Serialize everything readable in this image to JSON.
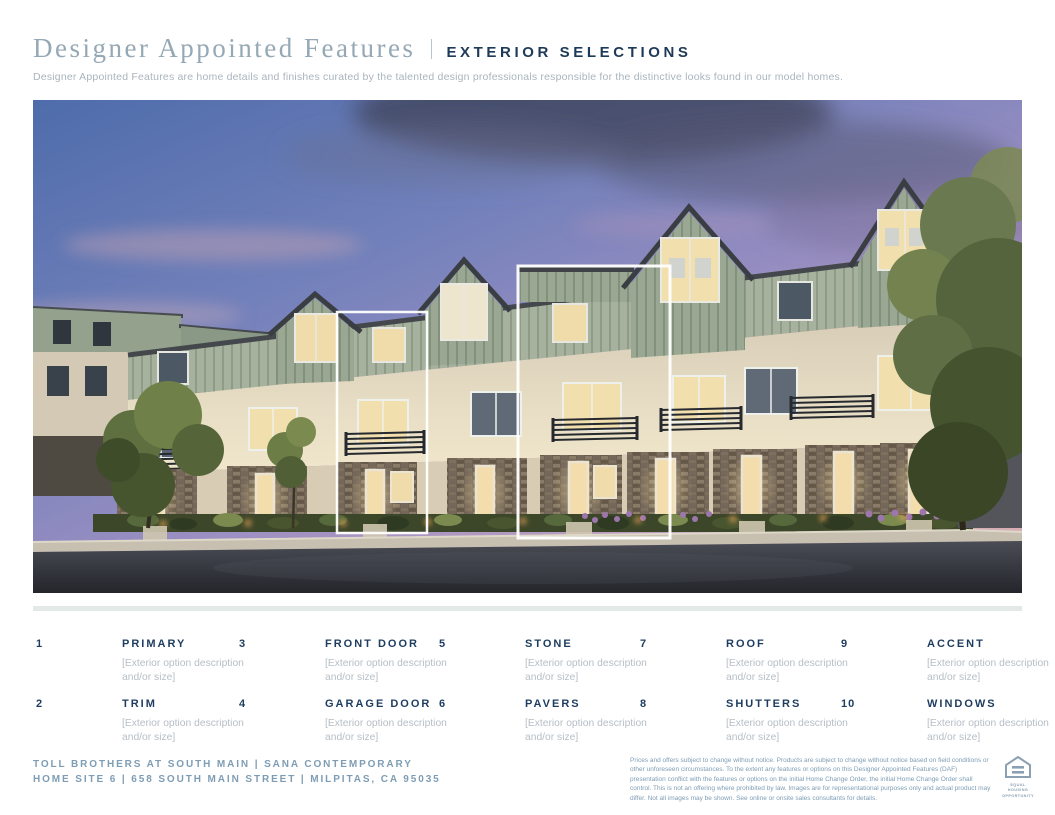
{
  "header": {
    "title_serif": "Designer Appointed Features",
    "title_sans": "EXTERIOR SELECTIONS",
    "subtitle": "Designer Appointed Features are home details and finishes curated by the talented design professionals responsible for the distinctive looks found in our model homes."
  },
  "hero": {
    "description": "Dusk rendering of three-story contemporary townhomes with sage green board-and-batten upper floors, cream stucco, stone veneer bases, lit windows, balconies and street landscaping; two units outlined with white highlight boxes",
    "highlight_boxes": [
      "home-site-highlight-left",
      "home-site-highlight-right"
    ]
  },
  "features": {
    "items": [
      {
        "number": "1",
        "label": "PRIMARY",
        "desc": "[Exterior option description and/or size]"
      },
      {
        "number": "3",
        "label": "FRONT DOOR",
        "desc": "[Exterior option description and/or size]"
      },
      {
        "number": "5",
        "label": "STONE",
        "desc": "[Exterior option description and/or size]"
      },
      {
        "number": "7",
        "label": "ROOF",
        "desc": "[Exterior option description and/or size]"
      },
      {
        "number": "9",
        "label": "ACCENT",
        "desc": "[Exterior option description and/or size]"
      },
      {
        "number": "2",
        "label": "TRIM",
        "desc": "[Exterior option description and/or size]"
      },
      {
        "number": "4",
        "label": "GARAGE DOOR",
        "desc": "[Exterior option description and/or size]"
      },
      {
        "number": "6",
        "label": "PAVERS",
        "desc": "[Exterior option description and/or size]"
      },
      {
        "number": "8",
        "label": "SHUTTERS",
        "desc": "[Exterior option description and/or size]"
      },
      {
        "number": "10",
        "label": "WINDOWS",
        "desc": "[Exterior option description and/or size]"
      }
    ]
  },
  "footer": {
    "community_line1": "TOLL BROTHERS AT SOUTH MAIN | SANA CONTEMPORARY",
    "community_line2": "HOME SITE 6 | 658 SOUTH MAIN STREET | MILPITAS, CA 95035",
    "legal": "Prices and offers subject to change without notice. Products are subject to change without notice based on field conditions or other unforeseen circumstances. To the extent any features or options on this Designer Appointed Features (DAF) presentation conflict with the features or options on the initial Home Change Order, the initial Home Change Order shall control. This is not an offering where prohibited by law. Images are for representational purposes only and actual product may differ. Not all images may be shown. See online or onsite sales consultants for details.",
    "equal_housing_line1": "EQUAL HOUSING",
    "equal_housing_line2": "OPPORTUNITY"
  },
  "colors": {
    "navy": "#1d3c5f",
    "slate_blue": "#7e9db5",
    "title_gray_blue": "#95a8b5",
    "muted_gray": "#b6bec5",
    "divider_gray": "#e2e9e6",
    "siding_green": "#a6b29d",
    "stucco_cream": "#e9dfc6",
    "stone_brown": "#6e6152",
    "highlight_box": "#ffffff"
  }
}
